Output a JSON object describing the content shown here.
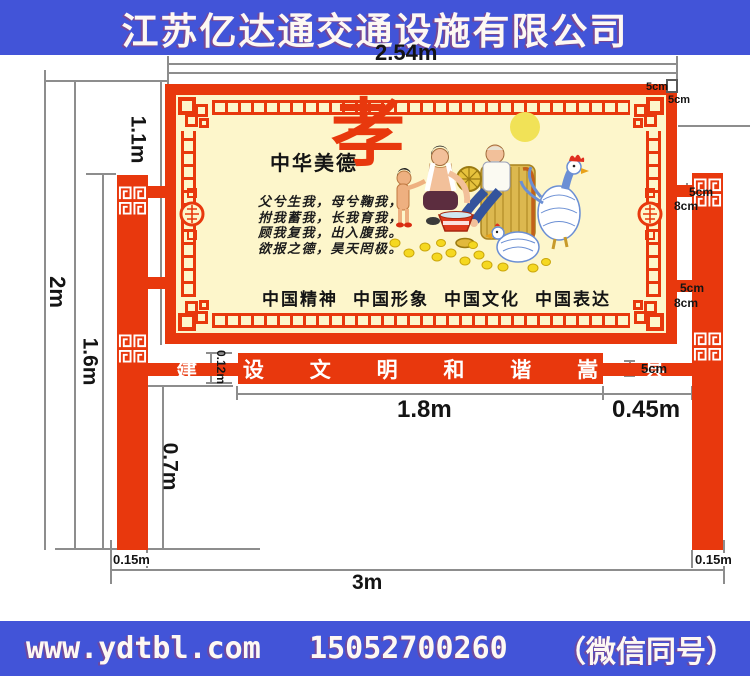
{
  "colors": {
    "band_blue": "#4254d8",
    "structure_red": "#e8380d",
    "board_cream": "#fdf6cb",
    "dim_gray": "#8d8d8d"
  },
  "header": {
    "text": "江苏亿达通交通设施有限公司"
  },
  "footer": {
    "website": "www.ydtbl.com",
    "phone": "15052700260",
    "wechat": "（微信同号）"
  },
  "board": {
    "virtue_label": "中华美德",
    "virtue_char": "孝",
    "poem": [
      "父兮生我，母兮鞠我，",
      "拊我蓄我，长我育我，",
      "顾我复我，出入腹我。",
      "欲报之德，昊天罔极。"
    ],
    "slogans": [
      "中国精神",
      "中国形象",
      "中国文化",
      "中国表达"
    ]
  },
  "street_banner": {
    "text": "建设文明和谐嵩县",
    "display": "建 设 文 明 和 谐 嵩 县"
  },
  "dims": {
    "board_width": "2.54m",
    "board_height": "1.1m",
    "total_height": "2m",
    "post_height": "1.6m",
    "clearance": "0.7m",
    "base_width_left": "0.15m",
    "base_width_right": "0.15m",
    "overall_width": "3m",
    "banner_width": "1.8m",
    "side_gap": "0.45m",
    "banner_height": "0.12m",
    "frame_bar_a": "5cm",
    "frame_bar_b": "5cm",
    "crossbar": "5cm",
    "connector_top_w": "5cm",
    "connector_top_h": "8cm",
    "connector_bottom_w": "5cm",
    "connector_bottom_h": "8cm"
  }
}
